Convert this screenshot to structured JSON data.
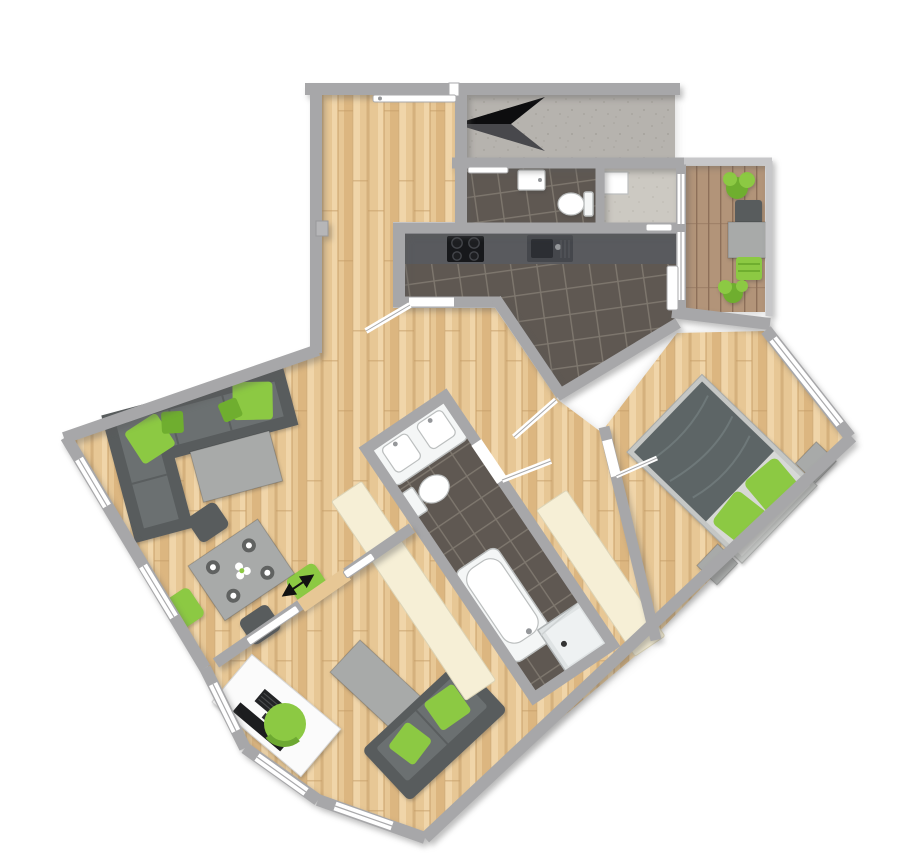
{
  "figure": {
    "kind": "apartment-floor-plan-3d-top-view",
    "visible_text": []
  },
  "colors": {
    "wood_base": "#e7c795",
    "wood_light": "#f0d5a9",
    "wood_dark": "#dcb680",
    "wood_line": "#c79e6a",
    "tile": "#5f5852",
    "grout": "#7e776e",
    "wall": "#a7a7a9",
    "wall_light": "#c7c7c9",
    "concrete": "#b6b3ae",
    "concrete_dot": "#a5a29b",
    "screed": "#ccc9c2",
    "screed_dot": "#bdbab2",
    "deck": "#b29479",
    "deck_gap": "#8d6f59",
    "cream": "#f6efd6",
    "cream_edge": "#dcd4b7",
    "green": "#8cc943",
    "green_dark": "#6fae2f",
    "sofa": "#6b7071",
    "sofa_dark": "#585c5d",
    "bed_blanket": "#5d6566",
    "bed_sheet": "#d7d8d6",
    "bed_frame": "#c5c7c5",
    "table_gray": "#a8aaa9",
    "fixture": "#f4f6f6",
    "fixture_edge": "#bcbfbf",
    "counter": "#595a5e",
    "counter_hi": "#71727a",
    "appliance_dark": "#17181b",
    "sink_dark": "#45474c",
    "sink_basin": "#2c2e33",
    "desk": "#fbfbfb",
    "screen": "#1c1d1f",
    "window": "#ffffff",
    "window_line": "#a9a9ab",
    "arrow_black": "#0d0d0f",
    "arrow_gray": "#48484c",
    "metal": "#95979a"
  },
  "rooms": [
    {
      "id": "entry-hall",
      "floor": "wood",
      "features": [
        "entrance-door",
        "radiator"
      ]
    },
    {
      "id": "wc",
      "floor": "dark-tile",
      "fixtures": [
        "wash-basin",
        "toilet"
      ]
    },
    {
      "id": "storage",
      "floor": "screed",
      "fixtures": [
        "shelf"
      ]
    },
    {
      "id": "kitchen",
      "floor": "dark-tile",
      "fixtures": [
        "counter",
        "cooktop",
        "kitchen-sink",
        "balcony-door"
      ]
    },
    {
      "id": "balcony",
      "floor": "wood-decking",
      "fixtures": [
        "plant",
        "outdoor-chair",
        "outdoor-table",
        "sun-lounger",
        "plant"
      ]
    },
    {
      "id": "living-room",
      "floor": "wood",
      "fixtures": [
        "corner-sofa",
        "coffee-table",
        "dining-table",
        "dining-chairs"
      ]
    },
    {
      "id": "bathroom",
      "floor": "dark-tile",
      "fixtures": [
        "double-washbasin",
        "toilet",
        "bathtub",
        "shower"
      ],
      "adjacent": [
        "wardrobe-left",
        "wardrobe-right"
      ]
    },
    {
      "id": "bedroom",
      "floor": "wood",
      "fixtures": [
        "double-bed",
        "nightstand-left",
        "nightstand-right"
      ]
    },
    {
      "id": "study",
      "floor": "wood",
      "fixtures": [
        "desk",
        "desk-chair",
        "monitor",
        "sofa",
        "coffee-table"
      ]
    }
  ],
  "symbols": {
    "north_arrow": "north-arrow",
    "sliding_door_arrow": "double-headed-arrow",
    "door_leaves": [
      "entrance-door-leaf",
      "kitchen-door-leaf",
      "bathroom-door-leaf",
      "bedroom-door-leaf"
    ]
  }
}
